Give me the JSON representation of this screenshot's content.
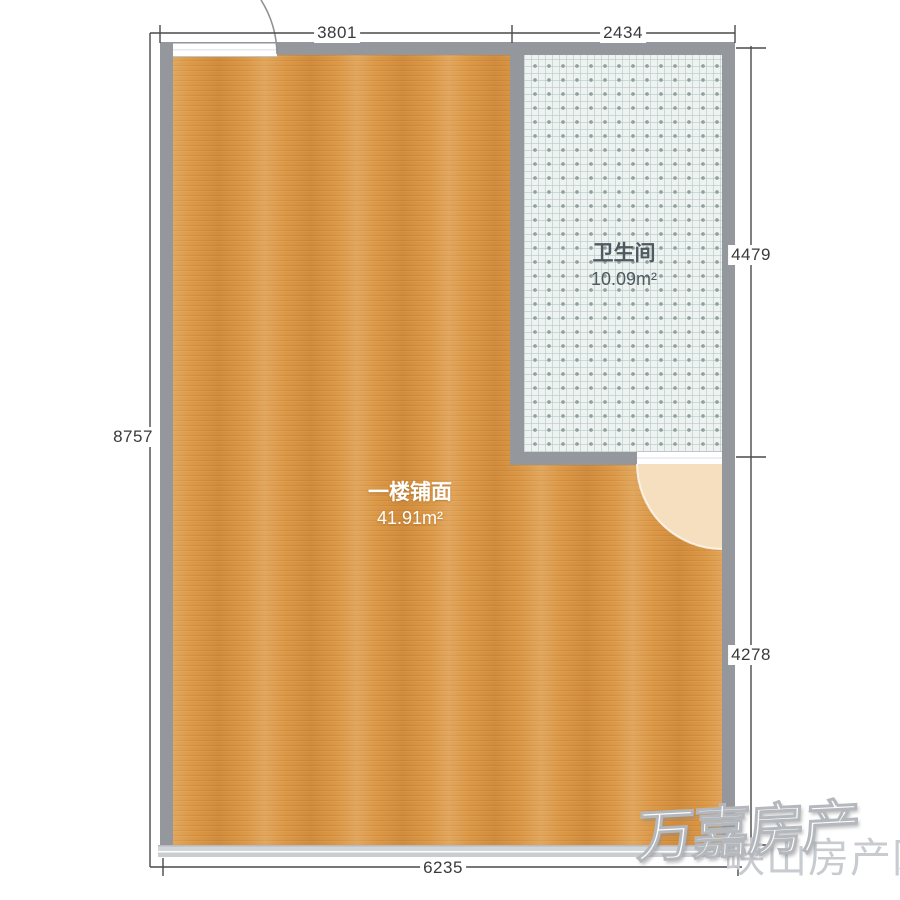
{
  "plan": {
    "rooms": {
      "shop": {
        "name": "一楼铺面",
        "area": "41.91m²"
      },
      "bathroom": {
        "name": "卫生间",
        "area": "10.09m²"
      }
    },
    "dimensions": {
      "top_left": "3801",
      "top_right": "2434",
      "left": "8757",
      "right_top": "4479",
      "right_bottom": "4278",
      "bottom": "6235"
    }
  },
  "watermarks": {
    "agency": "万嘉房产",
    "site": "峡山房产网"
  },
  "colors": {
    "wood_floor": "#da9542",
    "wall": "#94979c",
    "tile": "#eef3f1",
    "tile_dot": "#93a09d",
    "door_swing": "#f5dfbe",
    "bottom_wall": "#cbced3",
    "dimension_text": "#3a3a3a",
    "bathroom_text": "#4e5a60",
    "shop_text": "#ffffff",
    "watermark_gray": "#c8ccd1"
  }
}
